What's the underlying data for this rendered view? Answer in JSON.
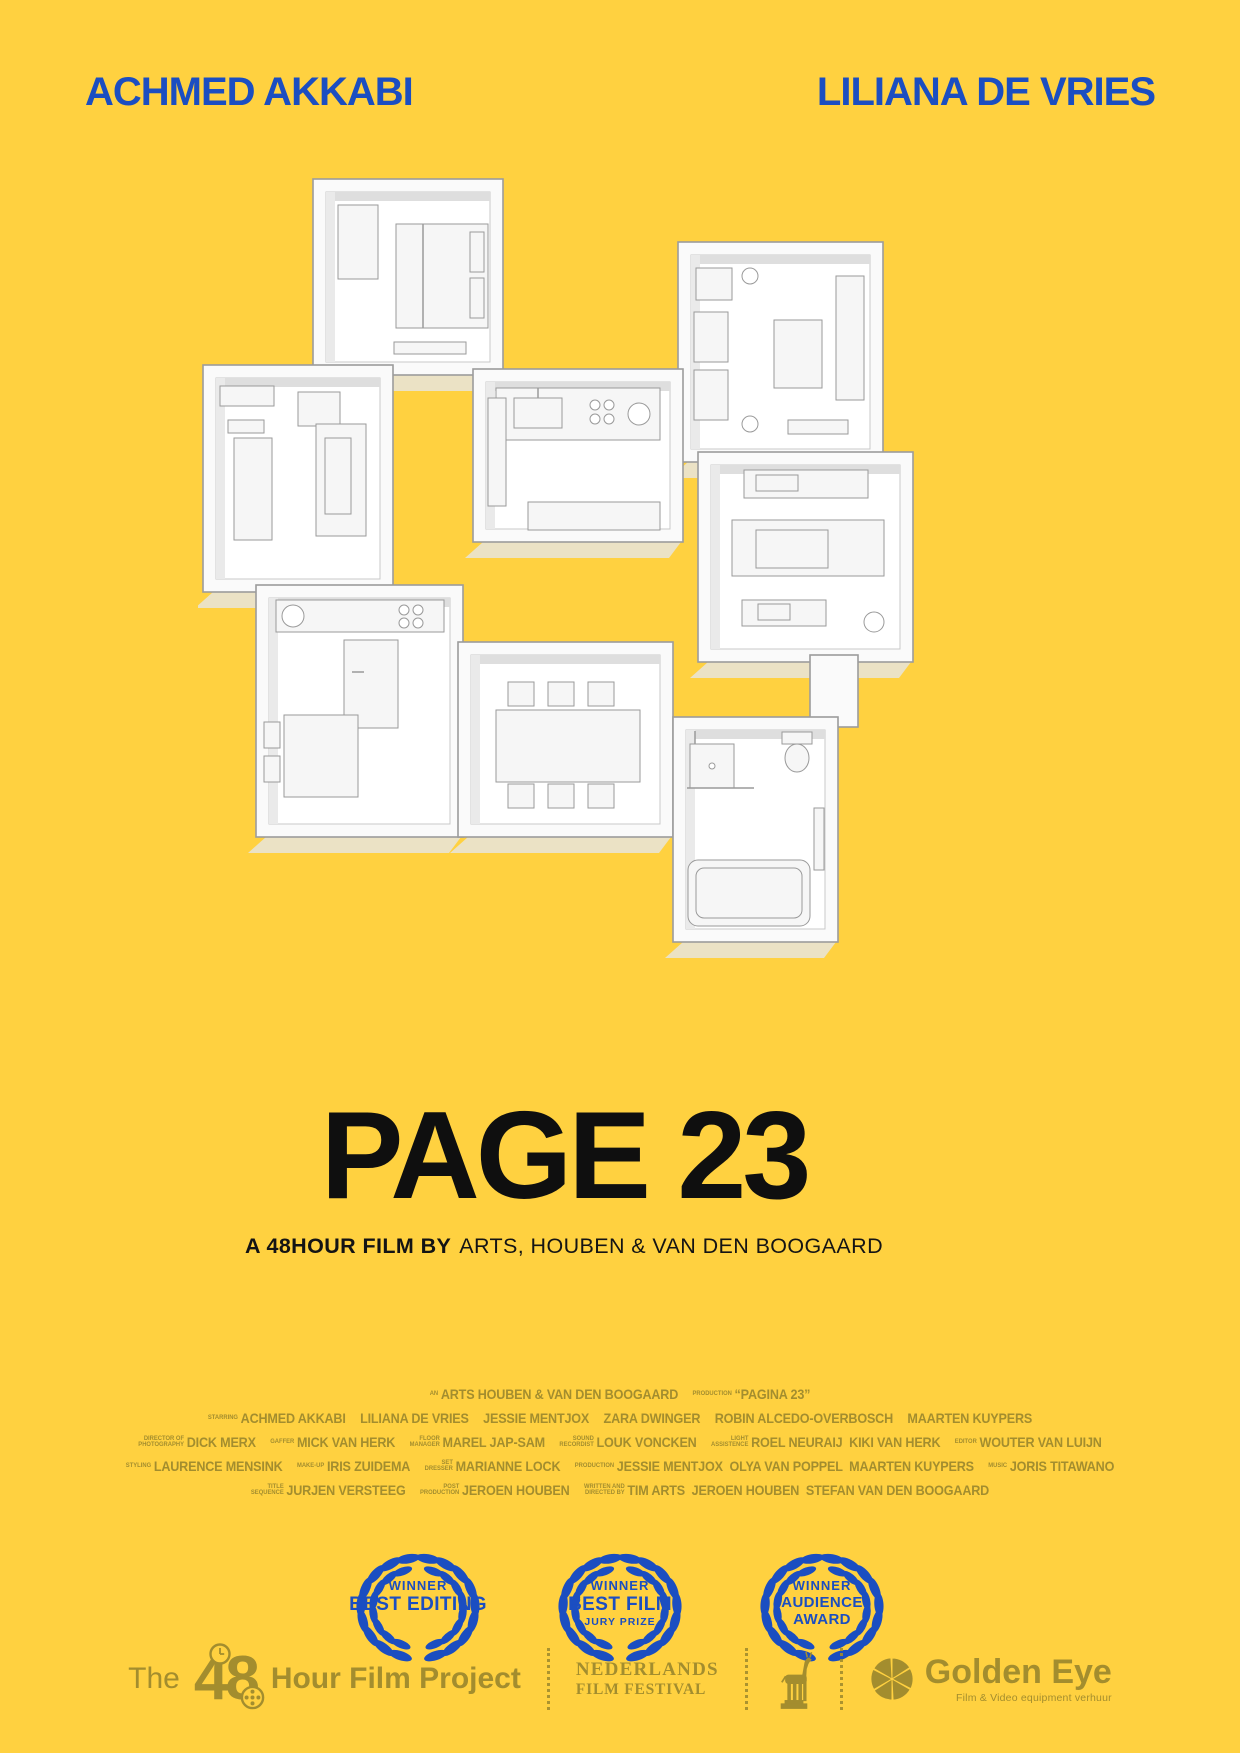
{
  "colors": {
    "background": "#FFD140",
    "blue": "#1B4EC1",
    "black": "#0F0F0F",
    "olive": "#A38D2E",
    "white": "#FFFFFF"
  },
  "billing": {
    "left": "ACHMED AKKABI",
    "right": "LILIANA DE VRIES"
  },
  "title": "PAGE 23",
  "subtitle": {
    "bold": "A 48HOUR FILM BY",
    "rest": "ARTS, HOUBEN & VAN DEN BOOGAARD"
  },
  "floorplan": {
    "rooms": [
      "bedroom",
      "living-room",
      "lounge",
      "kitchen",
      "media-room",
      "hallway",
      "kitchen-diner",
      "dining-room",
      "bathroom"
    ]
  },
  "credits": {
    "lines": [
      {
        "segments": [
          {
            "label": "AN",
            "name": "ARTS HOUBEN & VAN DEN BOOGAARD"
          },
          {
            "label": "PRODUCTION",
            "name": "“PAGINA 23”"
          }
        ]
      },
      {
        "segments": [
          {
            "label": "STARRING",
            "name": "ACHMED AKKABI"
          },
          {
            "label": "",
            "name": "LILIANA DE VRIES"
          },
          {
            "label": "",
            "name": "JESSIE MENTJOX"
          },
          {
            "label": "",
            "name": "ZARA DWINGER"
          },
          {
            "label": "",
            "name": "ROBIN ALCEDO-OVERBOSCH"
          },
          {
            "label": "",
            "name": "MAARTEN KUYPERS"
          }
        ]
      },
      {
        "segments": [
          {
            "label": "DIRECTOR OF\nPHOTOGRAPHY",
            "name": "DICK MERX"
          },
          {
            "label": "GAFFER",
            "name": "MICK VAN HERK"
          },
          {
            "label": "FLOOR\nMANAGER",
            "name": "MAREL JAP-SAM"
          },
          {
            "label": "SOUND\nRECORDIST",
            "name": "LOUK VONCKEN"
          },
          {
            "label": "LIGHT\nASSISTENCE",
            "name": "ROEL NEURAIJ  KIKI VAN HERK"
          },
          {
            "label": "EDITOR",
            "name": "WOUTER VAN LUIJN"
          }
        ]
      },
      {
        "segments": [
          {
            "label": "STYLING",
            "name": "LAURENCE MENSINK"
          },
          {
            "label": "MAKE-UP",
            "name": "IRIS ZUIDEMA"
          },
          {
            "label": "SET\nDRESSER",
            "name": "MARIANNE LOCK"
          },
          {
            "label": "PRODUCTION",
            "name": "JESSIE MENTJOX  OLYA VAN POPPEL  MAARTEN KUYPERS"
          },
          {
            "label": "MUSIC",
            "name": "JORIS TITAWANO"
          }
        ]
      },
      {
        "segments": [
          {
            "label": "TITLE\nSEQUENCE",
            "name": "JURJEN VERSTEEG"
          },
          {
            "label": "POST\nPRODUCTION",
            "name": "JEROEN HOUBEN"
          },
          {
            "label": "WRITTEN AND\nDIRECTED BY",
            "name": "TIM ARTS  JEROEN HOUBEN  STEFAN VAN DEN BOOGAARD"
          }
        ]
      }
    ]
  },
  "laurels": [
    {
      "award": "winner-best-editing",
      "lines": [
        "WINNER",
        "BEST EDITING",
        ""
      ]
    },
    {
      "award": "winner-best-film-jury-prize",
      "lines": [
        "WINNER",
        "BEST FILM",
        "JURY PRIZE"
      ]
    },
    {
      "award": "winner-audience-award",
      "lines": [
        "WINNER",
        "AUDIENCE",
        "AWARD"
      ]
    }
  ],
  "footer": {
    "fhp": {
      "the": "The",
      "number": "48",
      "rest": "Hour Film Project"
    },
    "nff": {
      "line1": "NEDERLANDS",
      "line2": "FILM FESTIVAL"
    },
    "golden_eye": {
      "title": "Golden Eye",
      "subtitle": "Film & Video equipment verhuur"
    }
  }
}
